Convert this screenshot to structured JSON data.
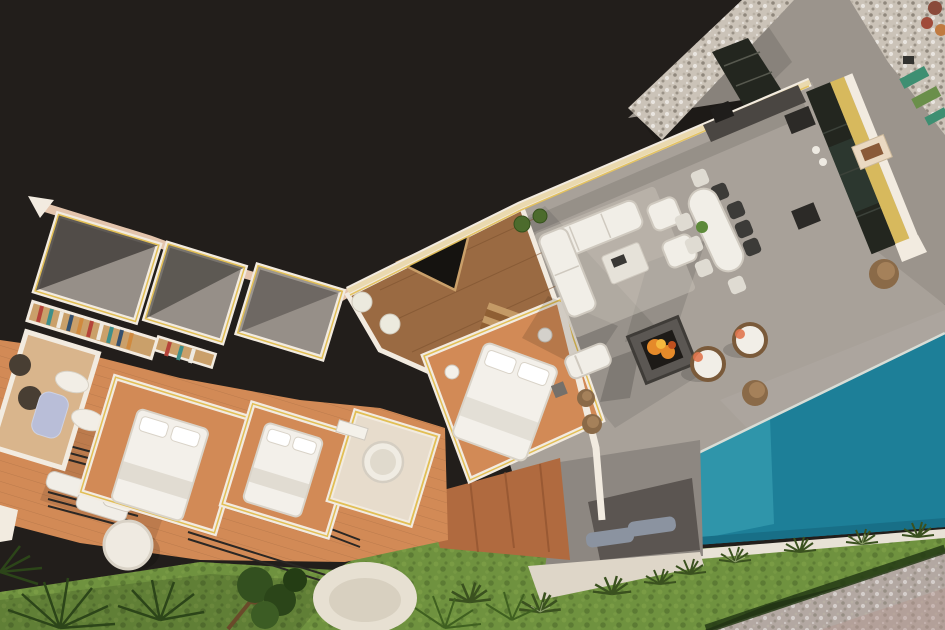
{
  "scene": {
    "type": "aerial-3d-render",
    "subject": "villa-floor-plan-with-roof-terrace-and-pool",
    "legend": [
      "bedroom-wing",
      "dressing-room",
      "bathrooms",
      "staircase-hall",
      "roof-terrace",
      "outdoor-lounge",
      "outdoor-dining",
      "fire-pit",
      "outdoor-kitchen",
      "swimming-pool",
      "lawn-garden",
      "palm-trees",
      "gravel-paths",
      "sun-deck"
    ]
  },
  "colors": {
    "background": "#221e1b",
    "path_gray": "#9b948c",
    "pebble": "#cbc3b8",
    "pebble_dot": "#8f877c",
    "terrace": "#a8a199",
    "terrace_dark": "#6e6963",
    "glass_dark": "#23261f",
    "glass_green": "#2e3b33",
    "counter_dark": "#4a4642",
    "appliance_dark": "#2c2a27",
    "wall_white": "#f2ebe0",
    "wall_cream": "#ead9ae",
    "wall_pink": "#e4c5ad",
    "wall_yellow": "#e2bf55",
    "pool_light": "#2f95aa",
    "pool_deep": "#1d7f98",
    "pool_dark": "#186f87",
    "pool_coping": "#e8e2d6",
    "grass": "#6f923f",
    "grass_light": "#86a64c",
    "grass_shadow": "#3a511f",
    "hedge_dark": "#243a15",
    "foliage": "#2c4519",
    "foliage_light": "#3f6020",
    "trunk": "#6a4a2a",
    "terracotta": "#d28a56",
    "terracotta_wall": "#b06a3f",
    "wood_floor": "#9a6a42",
    "plank": "#7d522f",
    "stair_light": "#c49a66",
    "stair_dark": "#8f5f33",
    "room_gray": "#968f88",
    "room_shadow": "#45413d",
    "shelf_wood": "#caa06a",
    "bed_white": "#f3f0ea",
    "linen_shadow": "#d9d3c8",
    "furniture_white": "#f1eee7",
    "furniture_shadow": "#cfc9bf",
    "table_white": "#e6e2d9",
    "chair_dark": "#3c3b38",
    "chair_white": "#dfdbd2",
    "pouf_brown": "#8a6a48",
    "pouf_light": "#a5815a",
    "rattan": "#7a5a3a",
    "accent_salmon": "#e0764f",
    "fire_orange": "#e58a2a",
    "fire_yellow": "#f4b83e",
    "ember_red": "#c0501f",
    "tub_lavender": "#b9bed8",
    "lounger_gray": "#8b93a0",
    "deck_gray": "#8d8781",
    "deck_shadow": "#55504b",
    "ledge_white": "#ded6c8",
    "corner_gravel": "#b3a8a2",
    "corner_rose": "#b5938c",
    "void_dark": "#151310",
    "railing": "#2a2724",
    "plant_green": "#4c6b2c",
    "stool_white": "#eceade",
    "tan_floor": "#d9b58c",
    "bath_pale": "#e7dccc"
  }
}
